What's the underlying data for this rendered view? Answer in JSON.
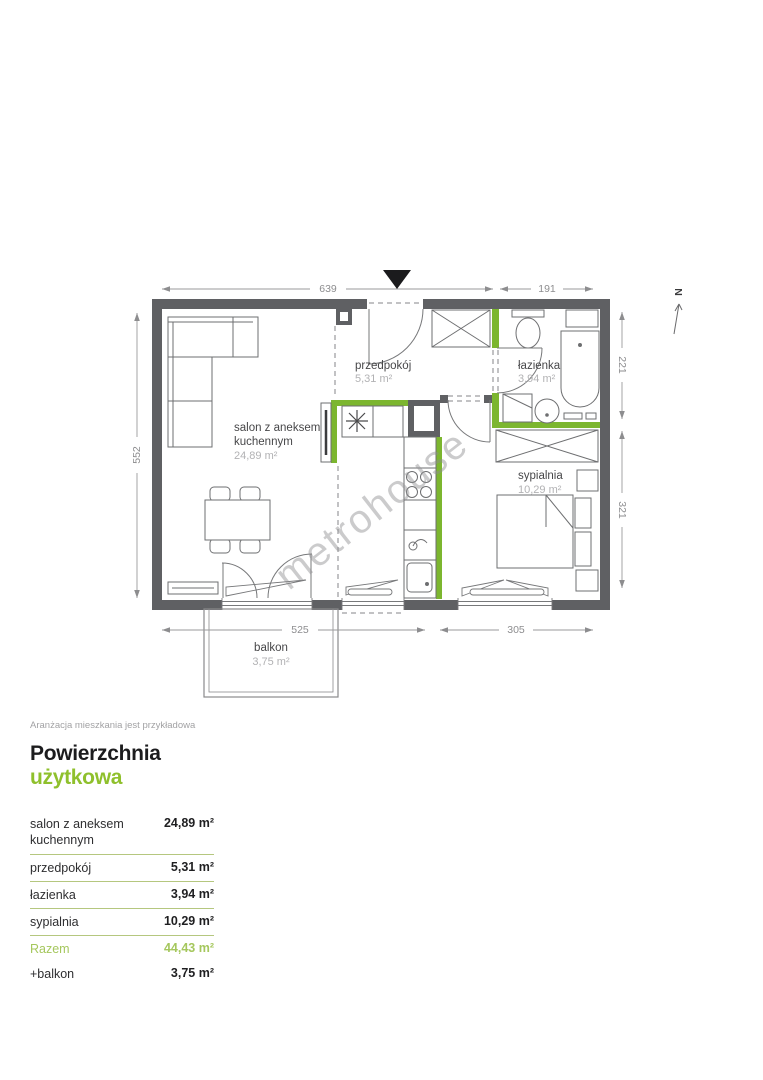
{
  "colors": {
    "wall_gray": "#5f6063",
    "wall_highlight_green": "#7cb62f",
    "accent_green": "#8fc02c",
    "total_green": "#a5c75d",
    "separator_green": "#b5c77f"
  },
  "plan": {
    "north": "N",
    "watermark": "metrohouse",
    "disclaimer": "Aranżacja mieszkania jest przykładowa",
    "rooms": {
      "salon": {
        "name_line1": "salon z aneksem",
        "name_line2": "kuchennym",
        "area": "24,89 m²"
      },
      "hall": {
        "name": "przedpokój",
        "area": "5,31 m²"
      },
      "bath": {
        "name": "łazienka",
        "area": "3,94 m²"
      },
      "bedroom": {
        "name": "sypialnia",
        "area": "10,29 m²"
      },
      "balcony": {
        "name": "balkon",
        "area": "3,75 m²"
      }
    },
    "dims": {
      "top_main": "639",
      "top_right": "191",
      "left": "552",
      "right_top": "221",
      "right_bottom": "321",
      "bottom_left": "525",
      "bottom_right": "305"
    }
  },
  "summary": {
    "title_black": "Powierzchnia",
    "title_green": "użytkowa",
    "rows": [
      {
        "label": "salon z aneksem kuchennym",
        "value": "24,89 m²"
      },
      {
        "label": "przedpokój",
        "value": "5,31 m²"
      },
      {
        "label": "łazienka",
        "value": "3,94 m²"
      },
      {
        "label": "sypialnia",
        "value": "10,29 m²"
      }
    ],
    "total": {
      "label": "Razem",
      "value": "44,43 m²"
    },
    "extra": {
      "label": "+balkon",
      "value": "3,75 m²"
    }
  }
}
